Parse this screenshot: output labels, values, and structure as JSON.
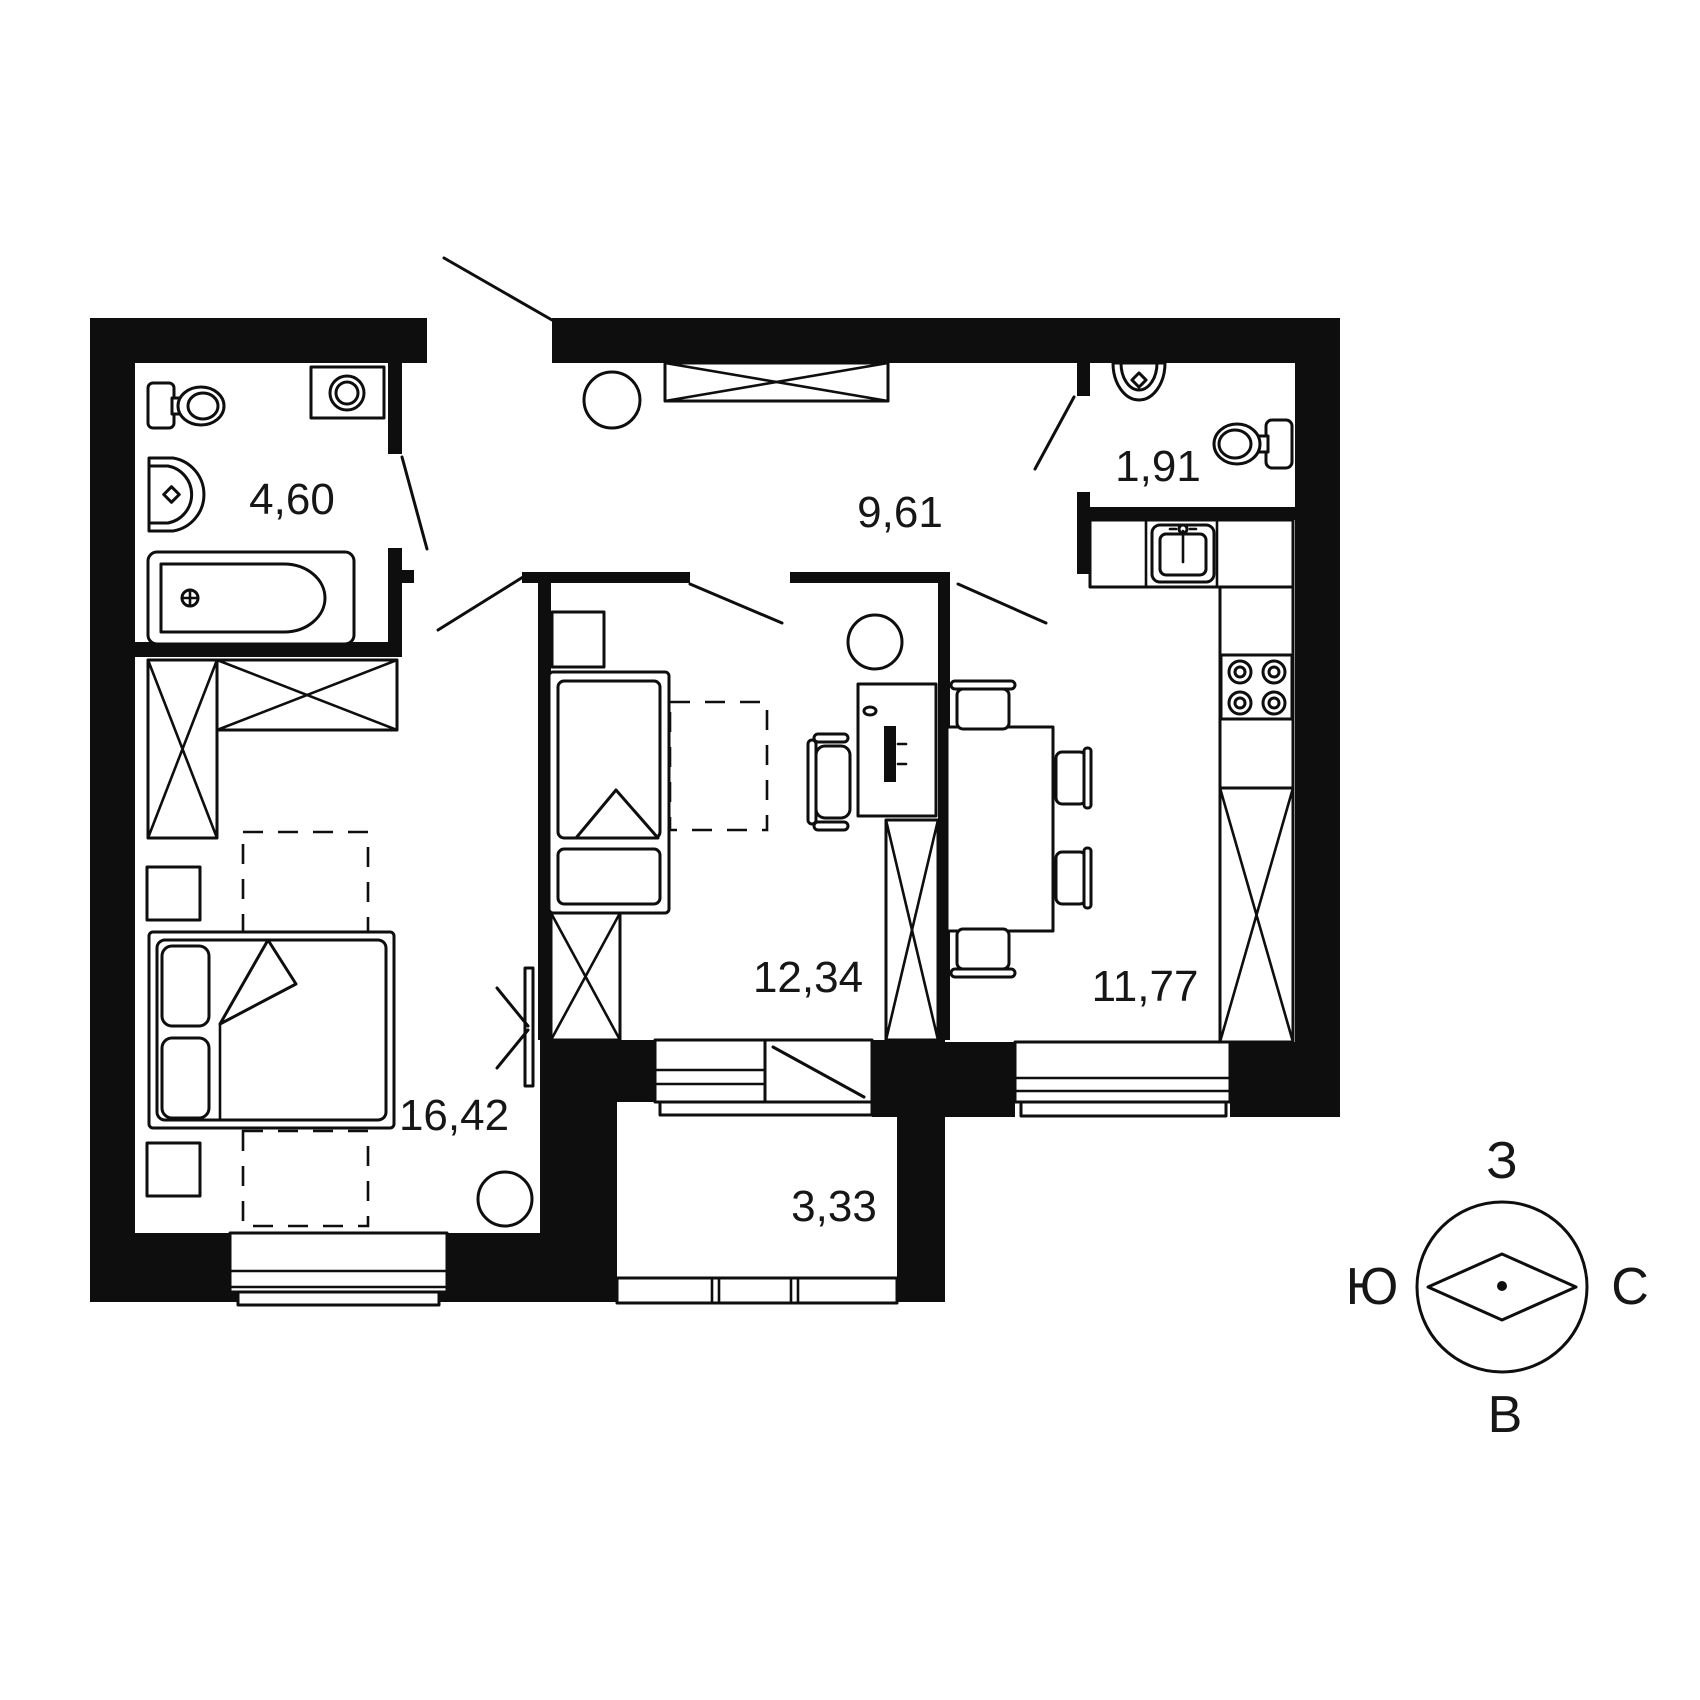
{
  "plan": {
    "type": "apartment-floor-plan",
    "rooms": [
      {
        "id": "bathroom",
        "area_label": "4,60"
      },
      {
        "id": "hallway",
        "area_label": "9,61"
      },
      {
        "id": "wc",
        "area_label": "1,91"
      },
      {
        "id": "bedroom",
        "area_label": "16,42"
      },
      {
        "id": "kids-room",
        "area_label": "12,34"
      },
      {
        "id": "kitchen",
        "area_label": "11,77"
      },
      {
        "id": "balcony",
        "area_label": "3,33"
      }
    ],
    "compass": {
      "top": "З",
      "right": "С",
      "bottom": "В",
      "left": "Ю"
    },
    "colors": {
      "ink": "#0e0e0e",
      "background": "#ffffff"
    }
  }
}
